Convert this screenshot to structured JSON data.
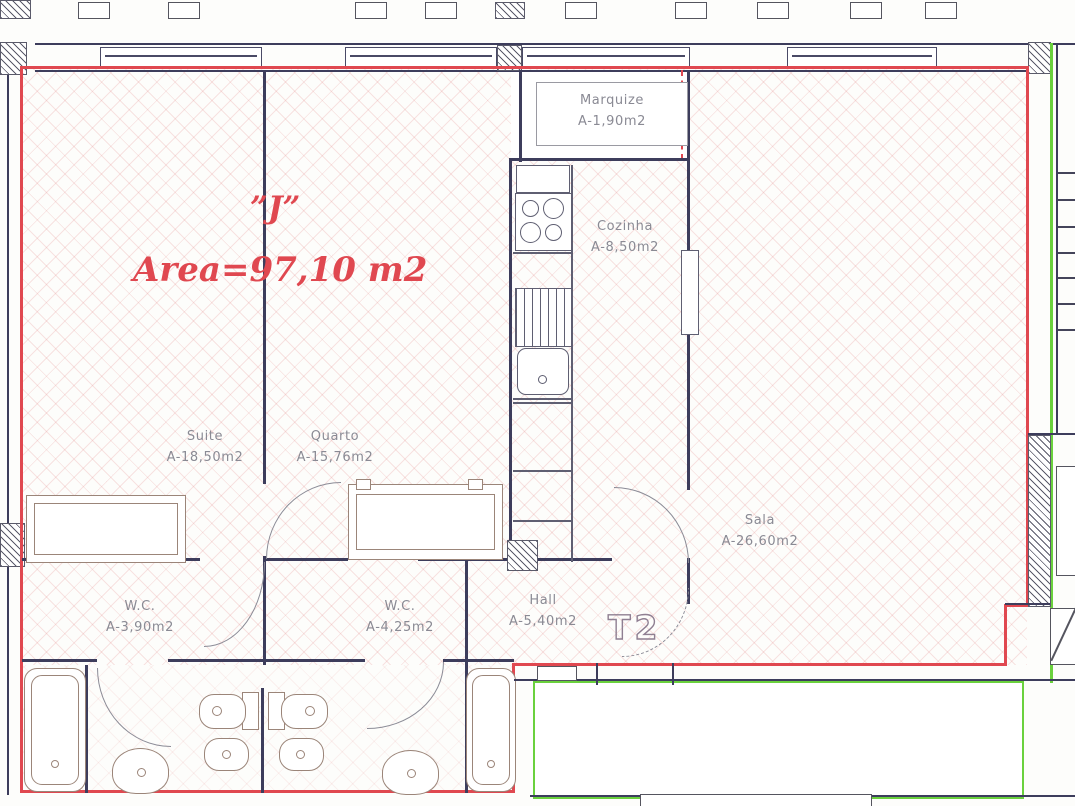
{
  "unit": {
    "id": "”J”",
    "area_label": "Area=97,10  m2",
    "type_label": "T2"
  },
  "rooms": [
    {
      "name": "Marquize",
      "area": "A-1,90m2"
    },
    {
      "name": "Cozinha",
      "area": "A-8,50m2"
    },
    {
      "name": "Suite",
      "area": "A-18,50m2"
    },
    {
      "name": "Quarto",
      "area": "A-15,76m2"
    },
    {
      "name": "Sala",
      "area": "A-26,60m2"
    },
    {
      "name": "W.C.",
      "area": "A-3,90m2"
    },
    {
      "name": "W.C.",
      "area": "A-4,25m2"
    },
    {
      "name": "Hall",
      "area": "A-5,40m2"
    }
  ],
  "colors": {
    "boundary": "#e04850",
    "wall": "#3d3d5c",
    "fixture": "#9b8579",
    "label": "#8a8a94",
    "green": "#6ad13d"
  }
}
